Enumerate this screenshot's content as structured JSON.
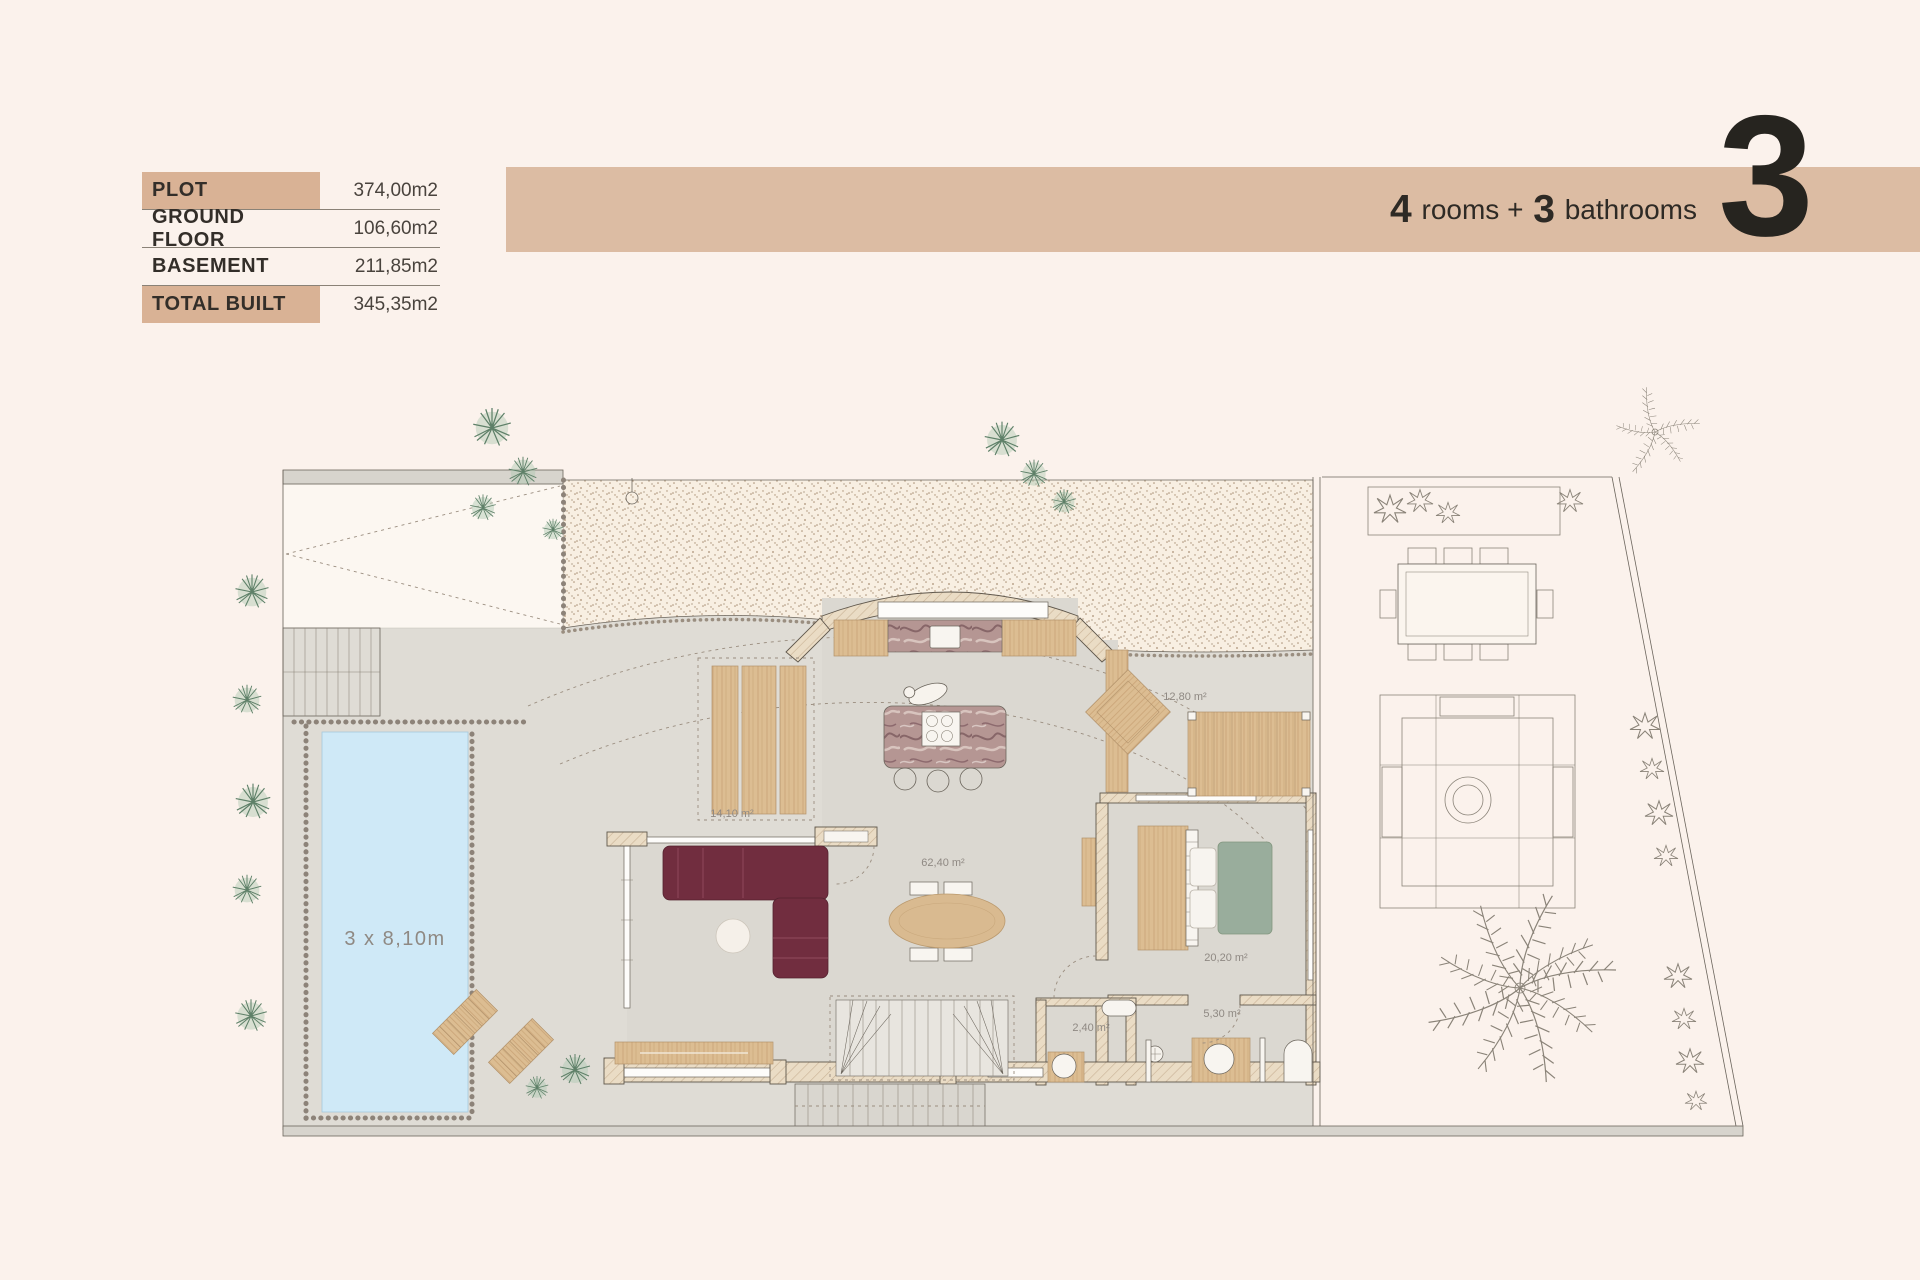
{
  "info_table": {
    "highlight_color": "#d9b295",
    "rows": [
      {
        "label": "PLOT",
        "value": "374,00m2",
        "highlight": true
      },
      {
        "label": "GROUND FLOOR",
        "value": "106,60m2",
        "highlight": false
      },
      {
        "label": "BASEMENT",
        "value": "211,85m2",
        "highlight": false
      },
      {
        "label": "TOTAL BUILT",
        "value": "345,35m2",
        "highlight": true
      }
    ]
  },
  "header": {
    "rooms_count": "4",
    "rooms_label": " rooms + ",
    "bath_count": "3",
    "bath_label": " bathrooms",
    "unit_number": "3",
    "band_color": "#dcbca3"
  },
  "plan": {
    "pool_label": "3 x 8,10m",
    "areas": [
      {
        "id": "terrace-west",
        "label": "14,10 m²"
      },
      {
        "id": "living-dining",
        "label": "62,40 m²"
      },
      {
        "id": "terrace-east",
        "label": "12,80 m²"
      },
      {
        "id": "bedroom",
        "label": "20,20 m²"
      },
      {
        "id": "wc",
        "label": "2,40 m²"
      },
      {
        "id": "bathroom",
        "label": "5,30 m²"
      }
    ],
    "colors": {
      "pool": "#cfe9f7",
      "sofa": "#712d3f",
      "bed": "#99ad9c",
      "wood": "#d9ba90",
      "paving": "#dfdcd5",
      "gravel": "#f8efe2"
    }
  }
}
